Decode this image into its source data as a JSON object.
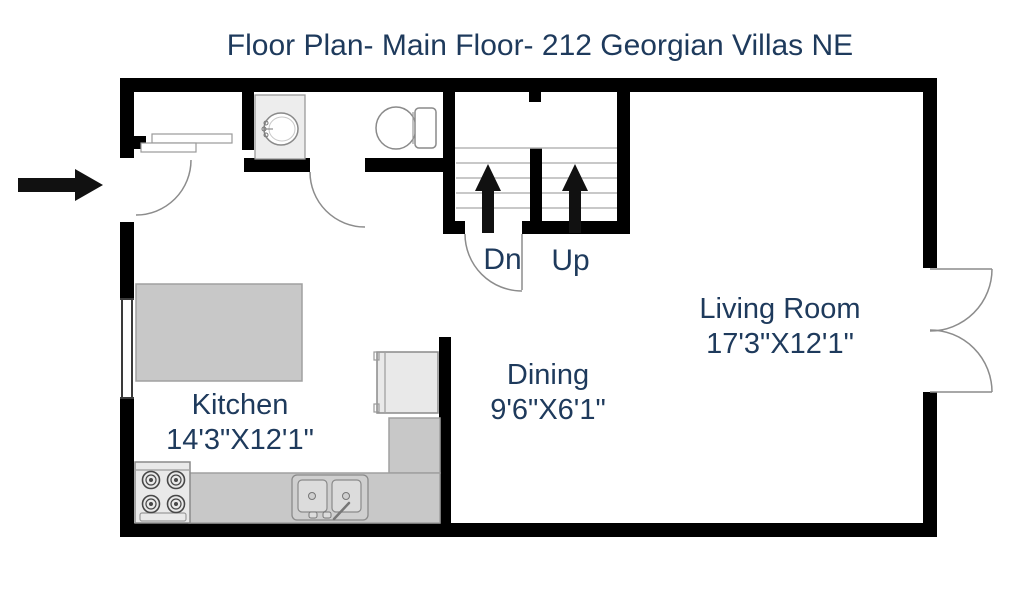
{
  "title": "Floor Plan- Main Floor- 212 Georgian Villas NE",
  "rooms": {
    "living_room": {
      "name": "Living Room",
      "size": "17'3\"X12'1\""
    },
    "dining": {
      "name": "Dining",
      "size": "9'6\"X6'1\""
    },
    "kitchen": {
      "name": "Kitchen",
      "size": "14'3\"X12'1\""
    }
  },
  "stairs": {
    "down": "Dn",
    "up": "Up"
  },
  "colors": {
    "label_text": "#1e3a5c",
    "wall": "#000000",
    "counter_fill": "#c8c8c8",
    "counter_edge": "#a0a0a0",
    "fixture_fill": "#ffffff",
    "fixture_edge": "#8a8a8a",
    "appliance_fill": "#e9e9e9",
    "door_arc": "#8c8c8c",
    "step_line": "#b5b5b5"
  }
}
